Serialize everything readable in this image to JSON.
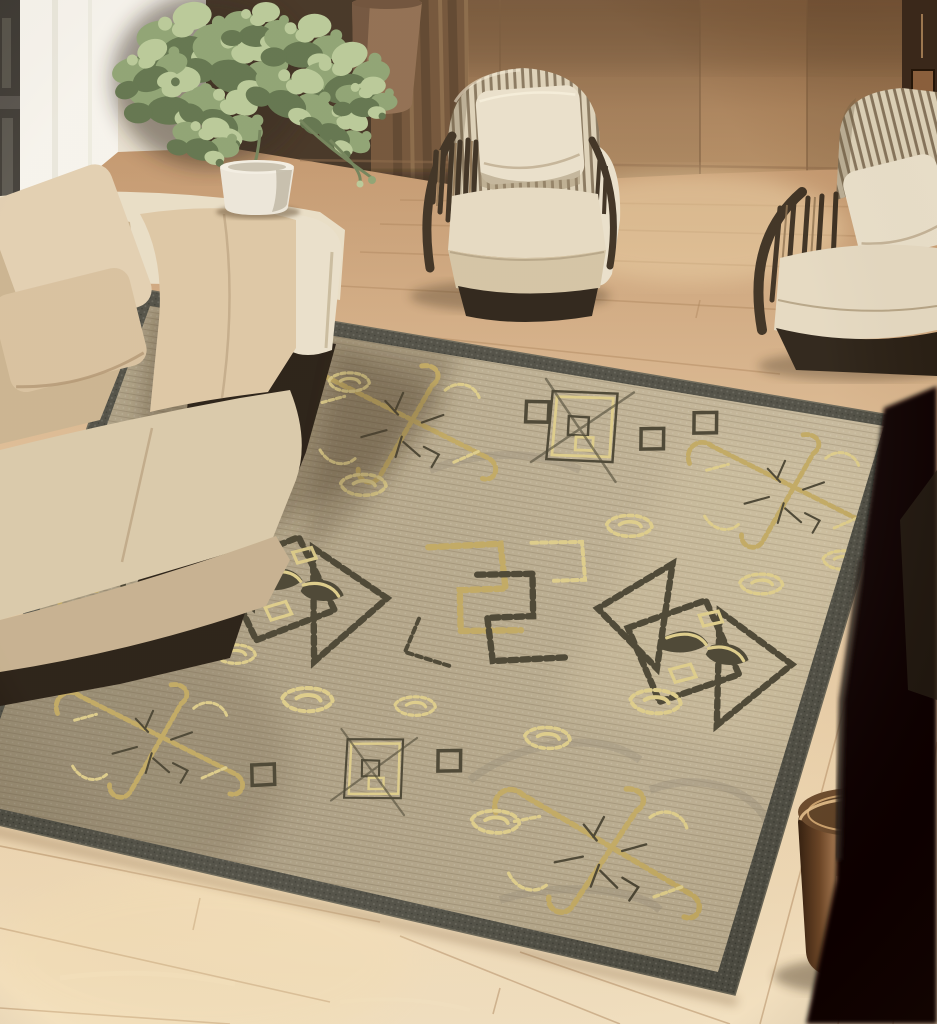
{
  "scene": {
    "type": "interior-photograph",
    "description": "Sunlit living room: cream fabric sofa by a bright window with sheer light, two dark-wood slatted armchairs with striped backrests against a wood-panel wall, leafy potted plants, a polished bronze drum side table, a dark chair silhouette at right, and a large beige jute rug with tribal chain-link, diamond-arrow and greek-key motifs in charcoal and gold on light oak plank flooring.",
    "objects": [
      "window",
      "sheer-light",
      "curtain",
      "tall-vase",
      "plant-left",
      "plant-right",
      "planter-pot",
      "wood-panel-wall",
      "cream-sofa",
      "sofa-pillows",
      "armchair-center",
      "armchair-right",
      "corner-shelf-frame",
      "area-rug",
      "rug-chain-cross-motifs",
      "rug-diamond-arrow-motifs",
      "rug-greek-key-motif",
      "rug-tilted-square-motifs",
      "rug-gold-rosettes",
      "wood-floor",
      "bronze-side-stool",
      "dark-chair-silhouette"
    ]
  },
  "palette": {
    "wall": "#a87f57",
    "wallTop": "#7e5a3a",
    "wallSeam": "#7c5b3b",
    "windowPane": "#f6f3ec",
    "windowFrame": "#3d3933",
    "glass": "#615c52",
    "wallWhite": "#e9e1d1",
    "curtain": "#6e4f33",
    "curtainDark": "#37281b",
    "curtainLight": "#8a6847",
    "vase": "#8d6a4c",
    "vaseShade": "#5f4530",
    "leaf": "#8ba06f",
    "leafLight": "#b7c795",
    "leafDark": "#5d7048",
    "stem": "#6e7f55",
    "pot": "#ebe5d8",
    "potShade": "#b4ab97",
    "floor1": "#c1946a",
    "floor2": "#ddbb93",
    "floor3": "#ecd3ad",
    "floor4": "#f2e0c0",
    "plank": "#a97f55",
    "rugBorder": "#4b4a40",
    "rugBorderHi": "#666253",
    "rug1": "#c7b99c",
    "rug2": "#b2a487",
    "rug3": "#9d9077",
    "motifDark": "#453f2d",
    "motifGold": "#bfa65e",
    "motifGoldL": "#dcca86",
    "sofaShell": "#e8dcc4",
    "sofaCushion": "#dcc5a2",
    "sofaCushionDk": "#c9b18c",
    "sofaSeat": "#d8c7a7",
    "sofaSeatDk": "#c4ae8c",
    "sofaBase": "#22180e",
    "stripeLight": "#dcd0b6",
    "stripeDark": "#7b6a50",
    "chairWood": "#382b1c",
    "chairWoodHi": "#8a6d4a",
    "chairCream": "#e9dfc9",
    "chairSeat": "#e4d8c0",
    "chairSeatDk": "#d2c2a2",
    "chairBase": "#271d12",
    "stool1": "#2e1b0c",
    "stool2": "#6b4526",
    "stool3": "#c59468",
    "stool4": "#e0b484",
    "stool5": "#8a5c34",
    "stoolTop": "#6b4a2c",
    "stoolRim": "#e6c08c",
    "black": "#090602",
    "shadow": "#3a2a16",
    "sun": "#f7e0b2"
  }
}
